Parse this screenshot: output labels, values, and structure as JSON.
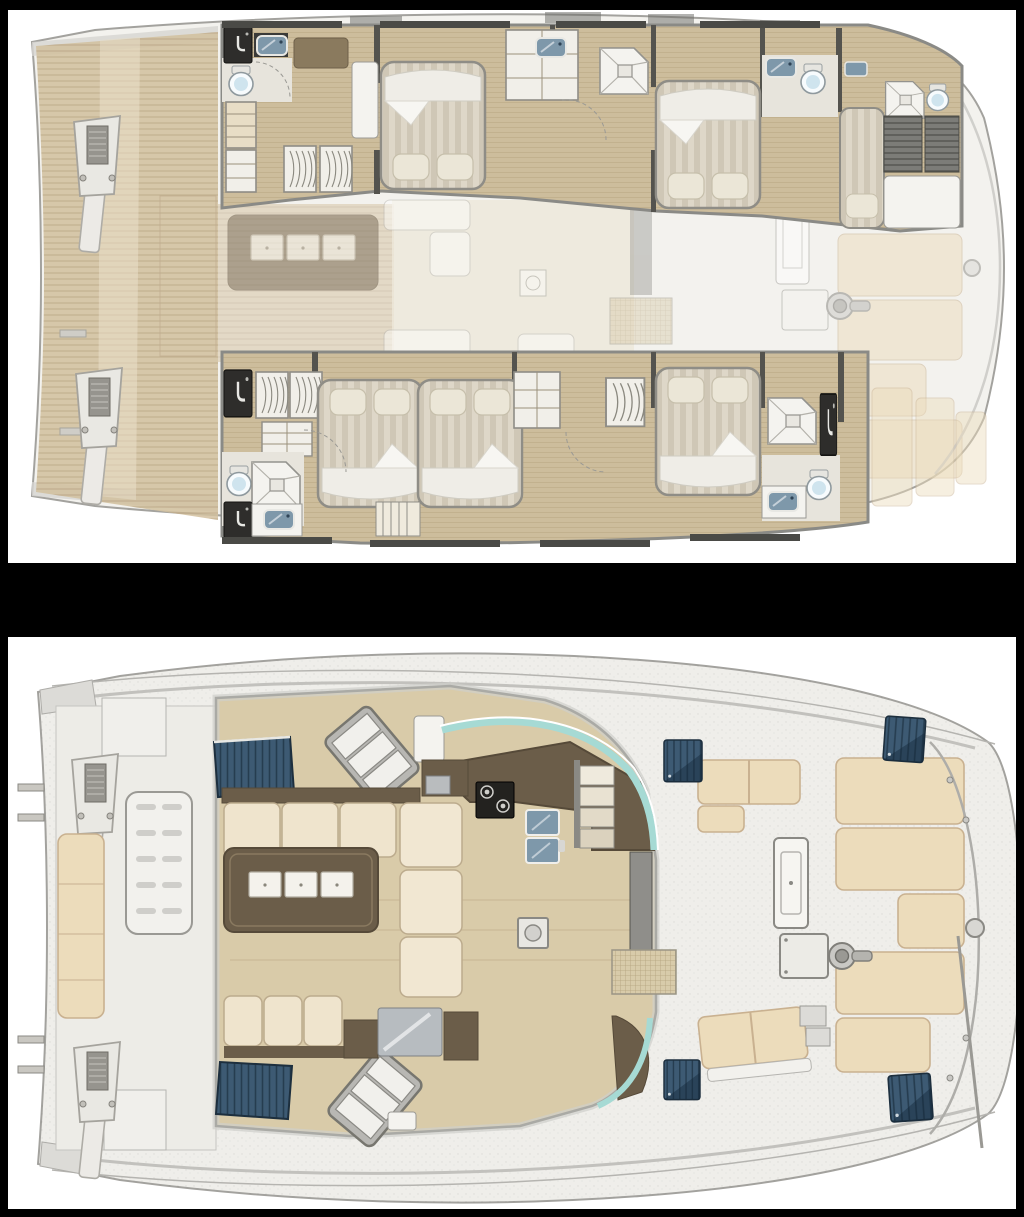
{
  "image": {
    "kind": "catamaran-yacht-deck-plan-brochure",
    "text_visible": "none",
    "background": "#000000"
  },
  "panels": [
    {
      "id": "lower-deck-plan",
      "label": "Lower deck accommodation plan: two hulls with double-bed cabins, single berth, wardrobes, shower rooms and toilets; ghosted main-deck furniture between hulls",
      "features": [
        "teak-aft-deck",
        "davit-posts",
        "owner-cabin-bed",
        "guest-double-beds",
        "single-berth",
        "shower-icon",
        "toilet-icon",
        "sink-icon",
        "hanging-locker-icon",
        "stairs-icon",
        "ghost-saloon-table",
        "ghost-sunpads"
      ]
    },
    {
      "id": "main-deck-plan",
      "label": "Main deck plan: saloon with galley, dinette sofa and coffee table, companionway stairs, tinted hull windows, forward sunpads, cockpit benches and winch",
      "features": [
        "galley-counter",
        "cooktop-icon",
        "fridge-icon",
        "dinette-sofa",
        "coffee-table-drawers",
        "hull-stairs",
        "tinted-window",
        "windshield-aqua",
        "sunpad-panels",
        "cockpit-table",
        "winch-icon",
        "deck-hatch",
        "lounger",
        "davit-posts"
      ]
    }
  ],
  "colors": {
    "frame": "#000000",
    "panelBg": "#ffffff",
    "hullFill": "#f3f2ee",
    "outline": "#a3a29e",
    "wallDark": "#54534e",
    "charcoal": "#2e2d2b",
    "deckPlank": "#d2c09e",
    "plankLine": "#b7a07c",
    "hullFloor": "#cdbd9c",
    "grain": "#b4a17e",
    "saloonFloor": "#d9cba9",
    "ghostCream": "#ece7da",
    "tile": "#e7e4dc",
    "mattress": "#ded7c8",
    "stripe": "#cfc7b6",
    "pillow": "#ebe6d7",
    "sheet": "#efede7",
    "whiteFurn": "#f4f3ef",
    "beige": "#ecdcbb",
    "beigeEdge": "#c9b190",
    "brown": "#6b5d49",
    "brownDark": "#564a39",
    "steelSink": "#7e98aa",
    "navy": "#3d5a73",
    "navyDark": "#263d50",
    "aqua": "#a6dad4",
    "grayBand": "#cfceca",
    "deckWhite": "#efeeea",
    "grate": "#d8cbaa",
    "grateLine": "#b3a27d",
    "ghost": "#d9d8d4"
  }
}
